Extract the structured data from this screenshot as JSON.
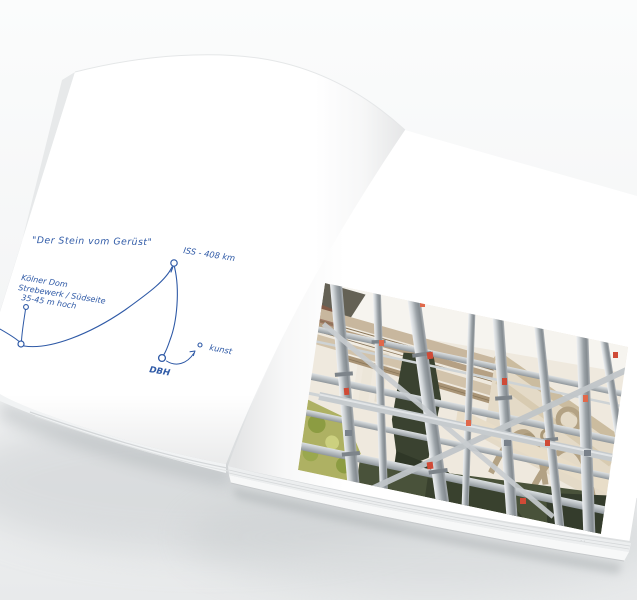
{
  "scene": {
    "title": "Open photo book mockup",
    "background_top": "#fbfcfc",
    "background_bottom": "#e8eaeb"
  },
  "left_page": {
    "ink_color": "#2e59a6",
    "quote": "\"Der Stein vom Gerüst\"",
    "annotations": {
      "iss_label": "ISS - 408 km",
      "location_lines": [
        "Kölner Dom",
        "Strebewerk / Südseite",
        "35-45 m hoch"
      ],
      "dbh_label": "DBH",
      "kunst_label": "kunst"
    }
  },
  "right_page": {
    "photo_subject": "scaffolding-at-gothic-cathedral",
    "page_marker": "· ·",
    "photo_colors": {
      "scaffold_gray": "#aab0b4",
      "stone_beige": "#e0d5c1",
      "tarp_green": "#3a422f",
      "foliage_green": "#aeb163",
      "clamp_red": "#cf4a36"
    }
  }
}
